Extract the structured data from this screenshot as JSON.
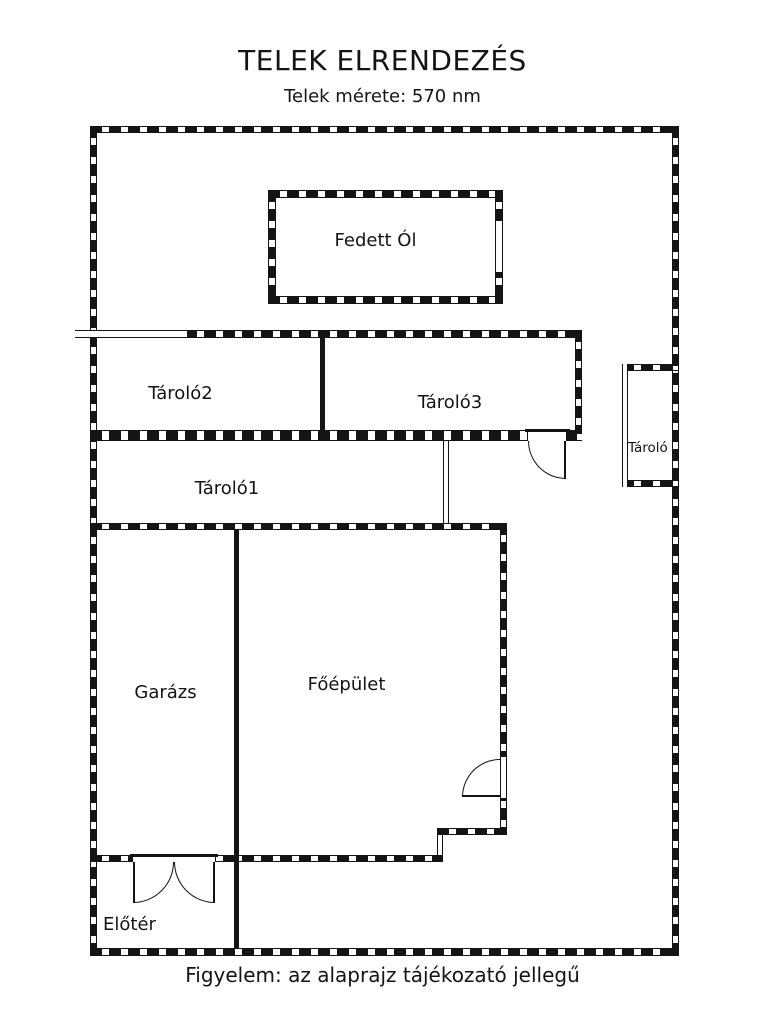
{
  "header": {
    "title": "TELEK ELRENDEZÉS",
    "subtitle": "Telek mérete: 570 nm"
  },
  "rooms": {
    "fedett_ol": "Fedett Ól",
    "tarolo2": "Tároló2",
    "tarolo3": "Tároló3",
    "tarolo1": "Tároló1",
    "tarolo_kicsi": "Tároló",
    "garazs": "Garázs",
    "foepulet": "Főépület",
    "eloter": "Előtér"
  },
  "footer": {
    "note": "Figyelem: az alaprajz tájékozató jellegű"
  },
  "colors": {
    "ink": "#141414",
    "background": "#ffffff"
  }
}
